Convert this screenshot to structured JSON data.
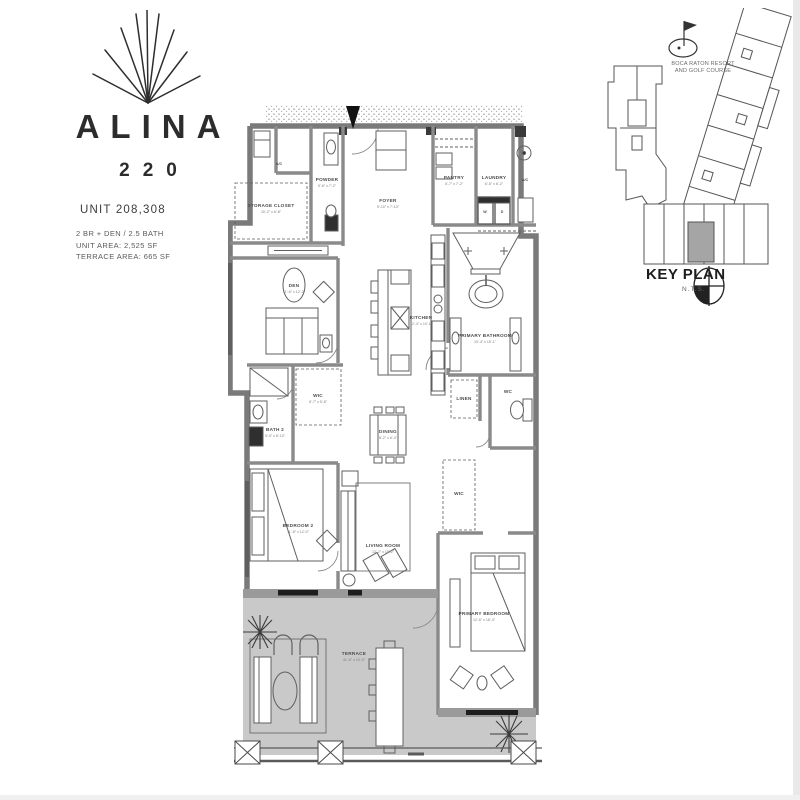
{
  "branding": {
    "name": "ALINA",
    "number": "220",
    "unit_line": "UNIT 208,308",
    "spec_lines": [
      "2 BR + DEN / 2.5 BATH",
      "UNIT AREA:      2,525 SF",
      "TERRACE AREA:  665 SF"
    ],
    "logo_icon": "sunburst-rays-icon"
  },
  "key_plan": {
    "title": "KEY PLAN",
    "scale": "N.T.S.",
    "note_line1": "BOCA RATON RESORT",
    "note_line2": "AND GOLF COURSE",
    "icons": [
      "golf-flag-icon",
      "compass-icon"
    ],
    "highlight_color": "#a5a5a5"
  },
  "floor_plan": {
    "colors": {
      "wall": "#7a7a7a",
      "terrace_fill": "#c9c9c9",
      "line": "#5f5f5f"
    },
    "labels": {
      "ac1": {
        "text": "A/C"
      },
      "ac2": {
        "text": "A/C"
      },
      "storage": {
        "text": "STORAGE CLOSET",
        "dims": "10'-2\" x 6'-8\""
      },
      "powder": {
        "text": "POWDER",
        "dims": "5'-6\" x 7'-2\""
      },
      "foyer": {
        "text": "FOYER",
        "dims": "5'-10\" x 7'-10\""
      },
      "pantry": {
        "text": "PANTRY",
        "dims": "5'-7\" x 7'-2\""
      },
      "laundry": {
        "text": "LAUNDRY",
        "dims": "6'-5\" x 6'-2\""
      },
      "washer": {
        "text": "W"
      },
      "dryer": {
        "text": "D"
      },
      "kitchen": {
        "text": "KITCHEN",
        "dims": "12'-4\" x 10'-1\""
      },
      "den": {
        "text": "DEN",
        "dims": "11'-6\" x 12'-2\""
      },
      "primary_bath": {
        "text": "PRIMARY BATHROOM",
        "dims": "10'-4\" x 15'-1\""
      },
      "wic_bed2": {
        "text": "WIC",
        "dims": "5'-7\" x 5'-8\""
      },
      "bath2": {
        "text": "BATH 2",
        "dims": "5'-0\" x 8'-10\""
      },
      "linen": {
        "text": "LINEN"
      },
      "wc": {
        "text": "WC"
      },
      "wic_primary": {
        "text": "WIC"
      },
      "dining": {
        "text": "DINING",
        "dims": "8'-2\" x 6'-4\""
      },
      "living": {
        "text": "LIVING ROOM",
        "dims": "13'-2\" x 15'-2\""
      },
      "bedroom2": {
        "text": "BEDROOM 2",
        "dims": "11'-8\" x 12'-0\""
      },
      "primary_bedroom": {
        "text": "PRIMARY BEDROOM",
        "dims": "12'-6\" x 16'-4\""
      },
      "terrace": {
        "text": "TERRACE",
        "dims": "41'-6\" x 10'-0\""
      }
    }
  }
}
